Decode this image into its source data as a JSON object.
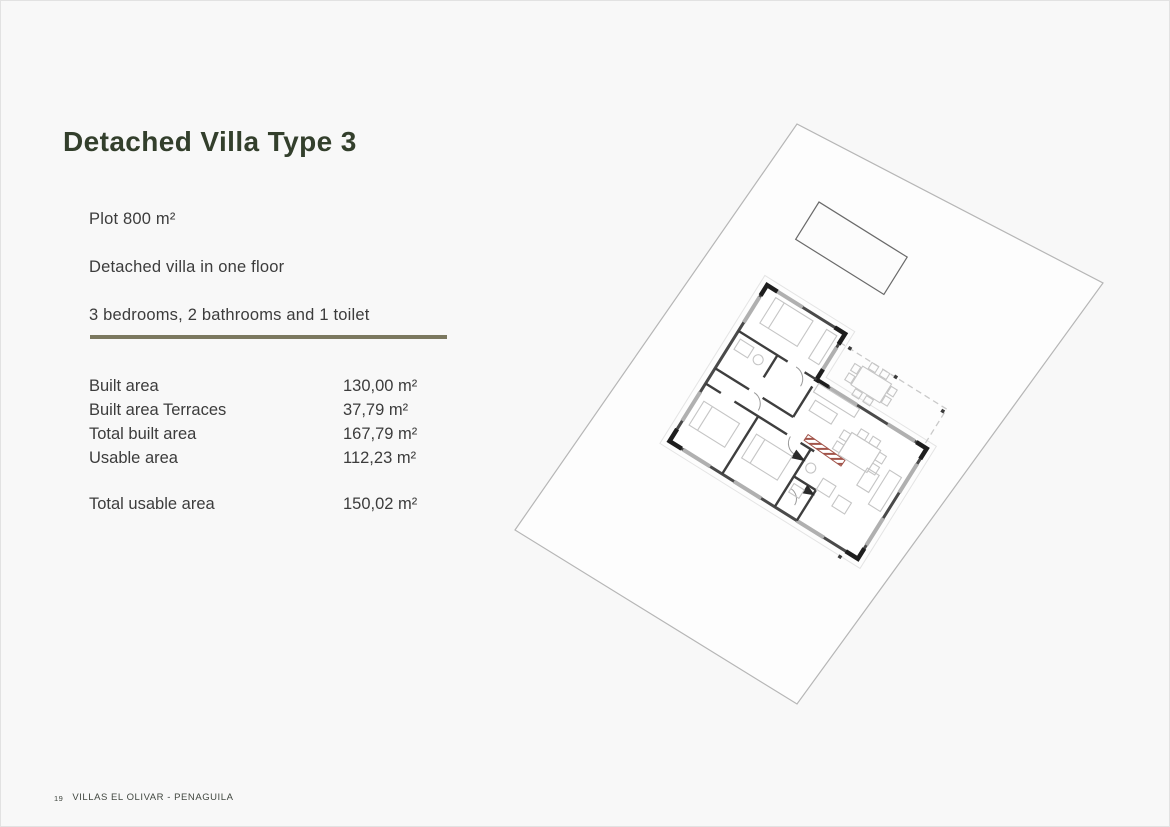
{
  "page": {
    "title": "Detached Villa Type 3",
    "intro_lines": [
      "Plot 800 m²",
      "Detached villa in one floor",
      "3 bedrooms, 2 bathrooms and 1 toilet"
    ],
    "areas": [
      {
        "label": "Built area",
        "value": "130,00 m²"
      },
      {
        "label": "Built area Terraces",
        "value": "37,79 m²"
      },
      {
        "label": "Total built area",
        "value": "167,79 m²"
      },
      {
        "label": "Usable area",
        "value": "112,23 m²"
      }
    ],
    "total_area": {
      "label": "Total usable area",
      "value": "150,02 m²"
    },
    "footer": {
      "page_number": "19",
      "project": "VILLAS EL OLIVAR - PENAGUILA"
    }
  },
  "plan": {
    "description": "Rotated site plan: plot boundary, pool, one-floor L-shaped villa with covered terrace",
    "rotation_degrees": 32,
    "colors": {
      "plot_line": "#b6b6b6",
      "wall": "#4a4a4a",
      "window": "#b0b0b0",
      "furniture": "#c5c5c5",
      "red_hatch": "#a2544a",
      "dashed_terrace": "#c9c9c9"
    }
  },
  "theme": {
    "background": "#f8f8f8",
    "title_green": "#333f2c",
    "separator_olive": "#7b785f",
    "body_text": "#3c3c3c",
    "footer_text": "#40463f"
  }
}
